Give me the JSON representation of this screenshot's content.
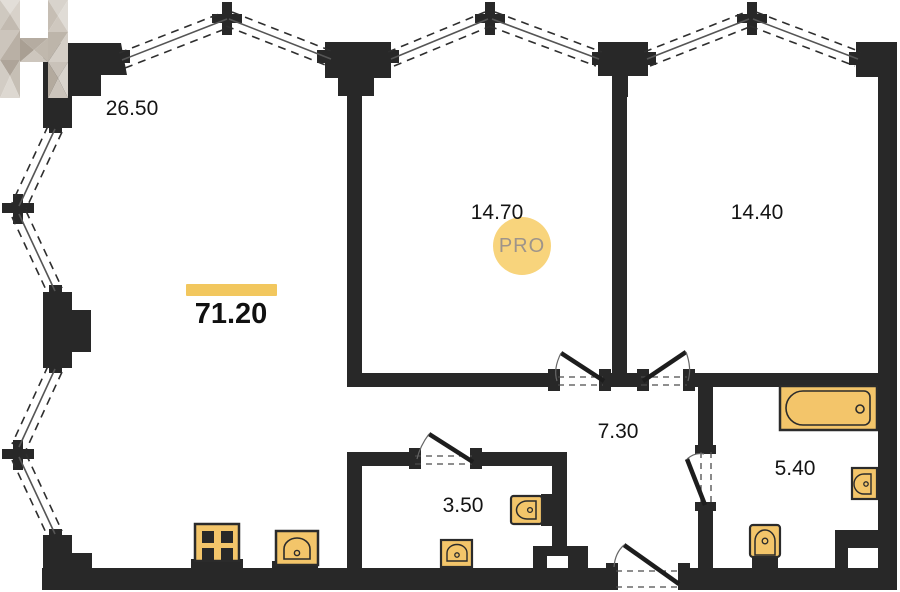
{
  "plan": {
    "total_area": "71.20",
    "rooms": [
      {
        "id": "living-kitchen",
        "area": "26.50"
      },
      {
        "id": "bedroom-1",
        "area": "14.70"
      },
      {
        "id": "bedroom-2",
        "area": "14.40"
      },
      {
        "id": "hallway",
        "area": "7.30"
      },
      {
        "id": "wc",
        "area": "3.50"
      },
      {
        "id": "bathroom",
        "area": "5.40"
      }
    ],
    "watermark": {
      "letter": "H",
      "badge_label": "PRO"
    },
    "colors": {
      "wall": "#282828",
      "window_line": "#555555",
      "fixture_fill": "#F3C56A",
      "accent_bar": "#F2C75E",
      "badge_bg": "#F8D47C",
      "badge_text": "#9E948A"
    }
  }
}
